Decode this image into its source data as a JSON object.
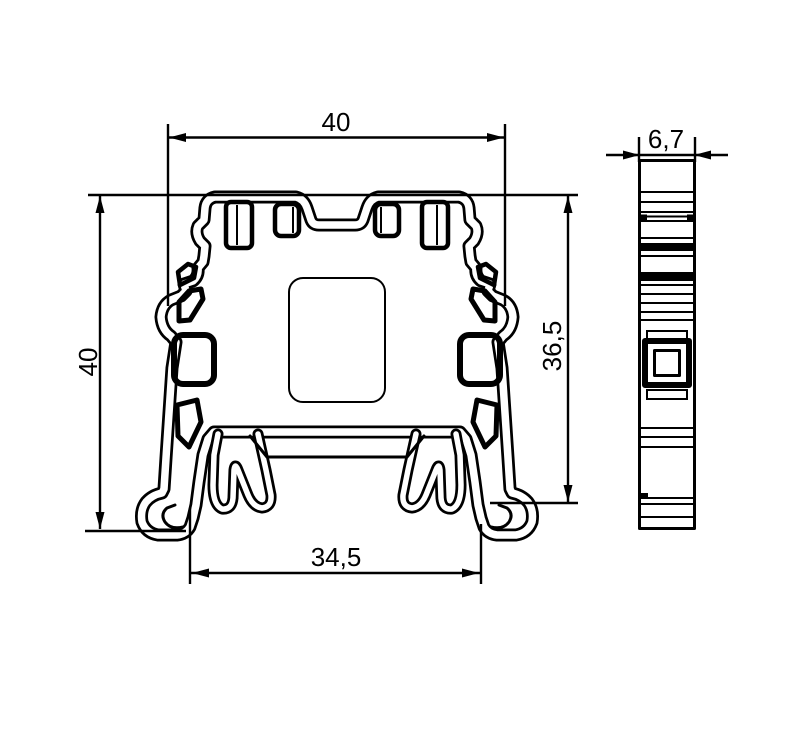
{
  "drawing": {
    "type": "technical-dimension-drawing",
    "subject": "terminal-block-profile",
    "views": {
      "front": "front cross-section view",
      "side": "side profile view"
    }
  },
  "colors": {
    "line": "#000000",
    "background": "#ffffff"
  },
  "dimensions": {
    "front_top_width": "40",
    "front_left_height": "40",
    "front_right_height": "36,5",
    "front_bottom_width": "34,5",
    "side_width": "6,7"
  }
}
